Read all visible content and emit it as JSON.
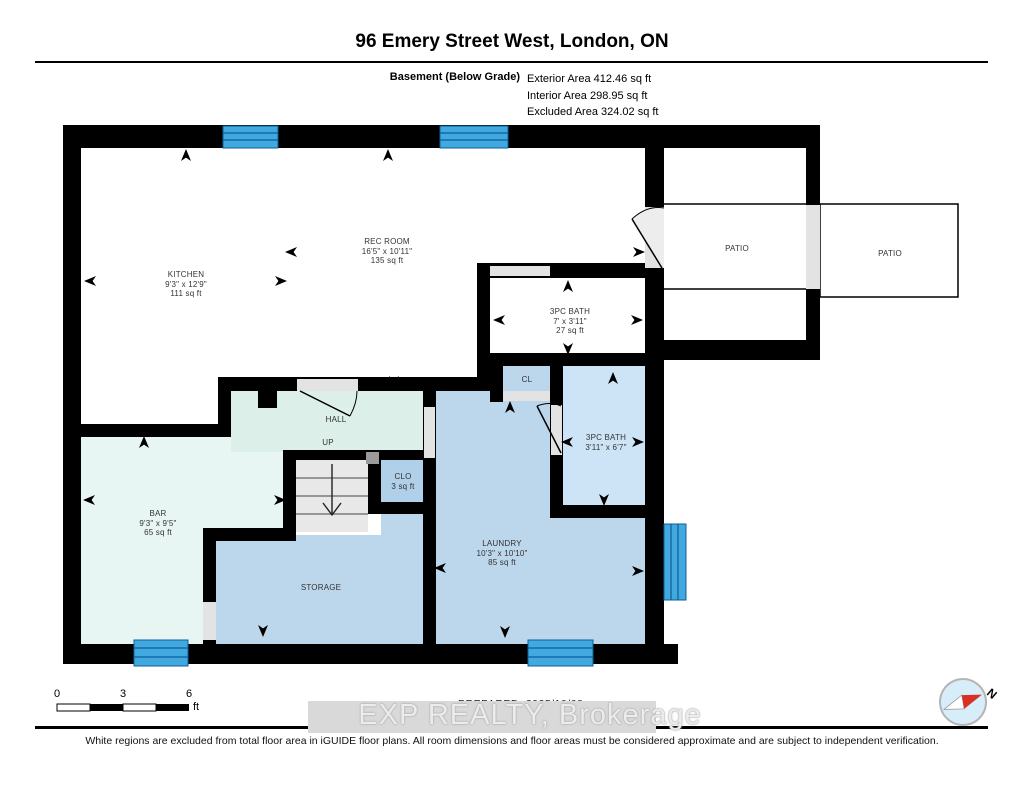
{
  "header": {
    "title": "96 Emery Street West, London, ON",
    "floor_label": "Basement (Below Grade)",
    "areas": [
      "Exterior Area 412.46 sq ft",
      "Interior Area 298.95 sq ft",
      "Excluded Area 324.02 sq ft"
    ]
  },
  "rooms": {
    "kitchen": {
      "name": "KITCHEN",
      "dims": "9'3\" x 12'9\"",
      "area": "111 sq ft"
    },
    "rec_room": {
      "name": "REC ROOM",
      "dims": "16'5\" x 10'11\"",
      "area": "135 sq ft"
    },
    "bath_top": {
      "name": "3PC BATH",
      "dims": "7' x 3'11\"",
      "area": "27 sq ft"
    },
    "bath_right": {
      "name": "3PC BATH",
      "dims": "3'11\" x 6'7\""
    },
    "bar": {
      "name": "BAR",
      "dims": "9'3\" x 9'5\"",
      "area": "65 sq ft"
    },
    "laundry": {
      "name": "LAUNDRY",
      "dims": "10'3\" x 10'10\"",
      "area": "85 sq ft"
    },
    "storage": {
      "name": "STORAGE"
    },
    "hall": {
      "name": "HALL"
    },
    "up_label": "UP",
    "cl": {
      "name": "CL"
    },
    "clo": {
      "name": "CLO",
      "area": "3 sq ft"
    },
    "patio_inner": {
      "name": "PATIO"
    },
    "patio_outer": {
      "name": "PATIO"
    }
  },
  "scale_bar": {
    "ticks": [
      "0",
      "3",
      "6"
    ],
    "unit": "ft"
  },
  "compass": {
    "label": "N"
  },
  "footer": {
    "prepared": "PREPARED: 2025/10/08",
    "watermark": "EXP REALTY, Brokerage",
    "disclaimer": "White regions are excluded from total floor area in iGUIDE floor plans. All room dimensions and floor areas must be considered approximate and are subject to independent verification."
  },
  "colors": {
    "wall": "#000000",
    "window_blue": "#41a8e0",
    "room_blue": "#bcd6eb",
    "room_blue_light": "#cde4f6",
    "room_mint": "#e7f6f3",
    "door_gray": "#e3e3e3",
    "compass_red": "#d93025"
  }
}
